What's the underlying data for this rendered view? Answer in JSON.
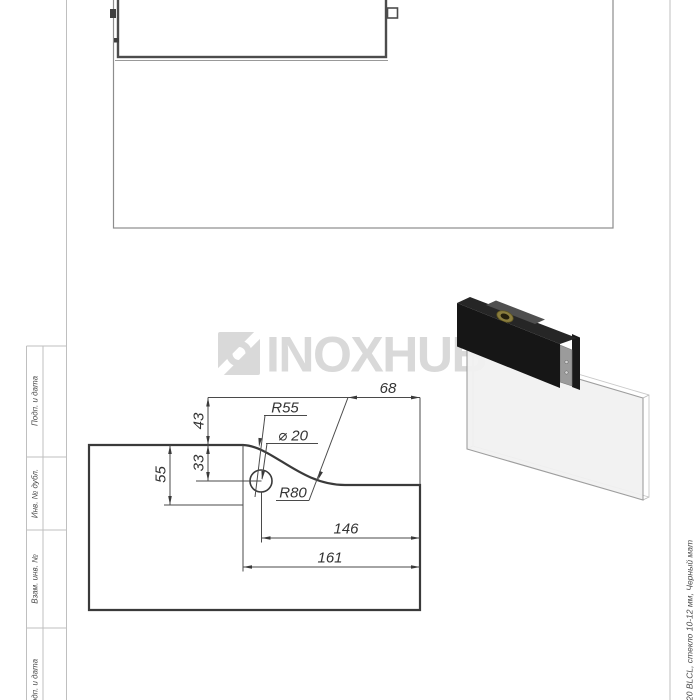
{
  "watermark": {
    "text": "INOXHUB",
    "color": "#d9d9d9"
  },
  "margin_labels": [
    "Подп. и дата",
    "Инв. № дубл.",
    "Взам. инв. №",
    "Подп. и дата"
  ],
  "side_note": "20 BLCL, стекло 10-12 мм, Черный мат",
  "dims": {
    "total_width": "161",
    "hole_offset": "146",
    "right_width": "68",
    "left_height": "55",
    "hole_height": "33",
    "step_height": "43",
    "top_radius": "R55",
    "hole_diameter": "⌀ 20",
    "bottom_radius": "R80"
  },
  "colors": {
    "outline": "#3a3a3a",
    "thin_line": "#4a4a4a",
    "frame_line": "#bfbfbf",
    "watermark": "#d9d9d9",
    "clamp_black": "#161616",
    "brass": "#8a7d3e",
    "glass_fill": "#f1f1f1"
  }
}
